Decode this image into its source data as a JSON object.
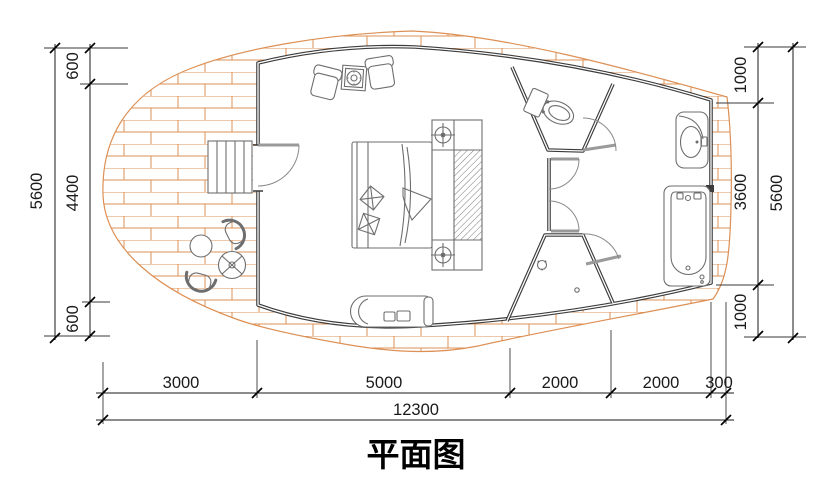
{
  "title": {
    "text": "平面图"
  },
  "colors": {
    "plank": "#dd9055",
    "wall": "#3c3c3c",
    "dim": "#1a1a1a",
    "furniture": "#6e6e6e"
  },
  "dimensions": {
    "left": {
      "total": "5600",
      "segments": [
        "600",
        "4400",
        "600"
      ]
    },
    "right": {
      "total": "5600",
      "segments": [
        "1000",
        "3600",
        "1000"
      ]
    },
    "bottom": {
      "segments": [
        "3000",
        "5000",
        "2000",
        "2000",
        "300"
      ],
      "total": "12300"
    }
  }
}
